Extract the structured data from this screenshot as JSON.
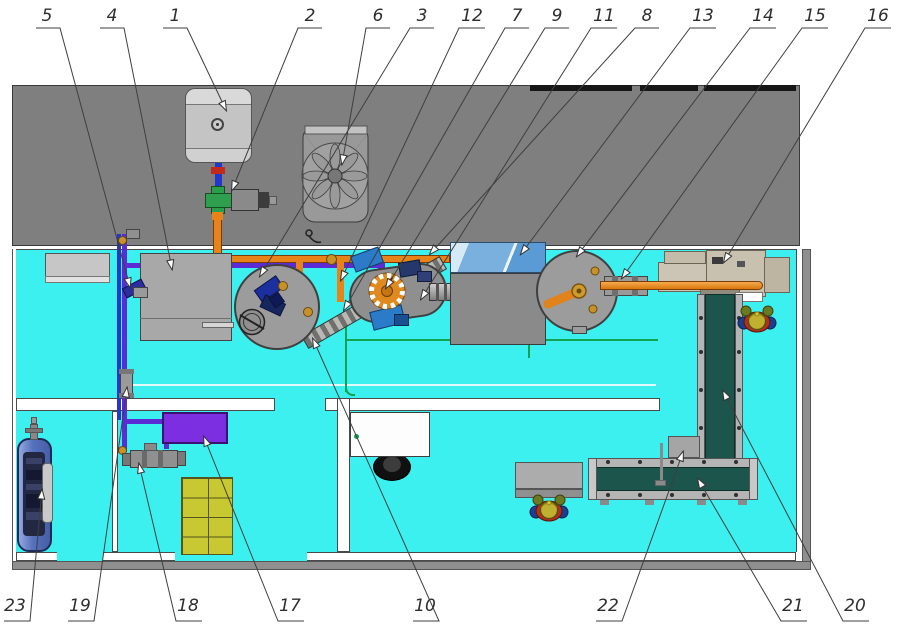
{
  "diagram": {
    "type": "factory-floor-plan-top-view",
    "callouts": [
      {
        "label": "5"
      },
      {
        "label": "4"
      },
      {
        "label": "1"
      },
      {
        "label": "2"
      },
      {
        "label": "6"
      },
      {
        "label": "3"
      },
      {
        "label": "12"
      },
      {
        "label": "7"
      },
      {
        "label": "9"
      },
      {
        "label": "11"
      },
      {
        "label": "8"
      },
      {
        "label": "13"
      },
      {
        "label": "14"
      },
      {
        "label": "15"
      },
      {
        "label": "16"
      },
      {
        "label": "23"
      },
      {
        "label": "19"
      },
      {
        "label": "18"
      },
      {
        "label": "17"
      },
      {
        "label": "10"
      },
      {
        "label": "22"
      },
      {
        "label": "21"
      },
      {
        "label": "20"
      }
    ]
  },
  "colors": {
    "floor": "#3DF0F0",
    "zone": "#7F7F7F",
    "outline": "#3F3F3F",
    "pipeOrange": "#E8831A",
    "pipePurple": "#5B2BD6",
    "pipeBlue": "#2337CC",
    "pipeGreen": "#12A24E",
    "beltTeal": "#1C554C",
    "railGray": "#B5B5B5",
    "machineGray": "#9C9C9C",
    "boxPurple": "#7B2FE0",
    "palletYellow": "#C8C832",
    "tankBlue": "#5570BD",
    "hopperBlue": "#5B9BD5",
    "beige": "#CCC4B4",
    "gearOrange": "#E0891E",
    "brass": "#C8922A",
    "pumpBlue": "#2B7BC8",
    "navy": "#22388F",
    "workerRed": "#B03020",
    "hatYellow": "#C0B030",
    "leader": "#3F3F3F"
  }
}
